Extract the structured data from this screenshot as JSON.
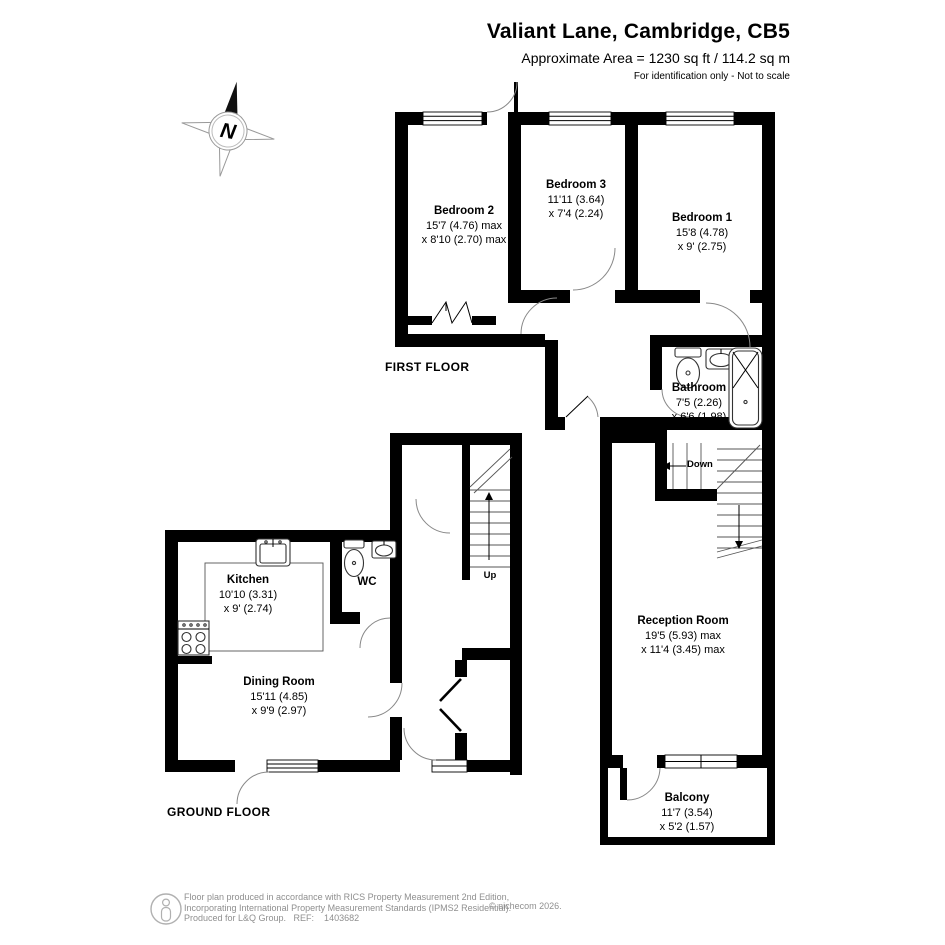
{
  "header": {
    "title": "Valiant Lane, Cambridge, CB5",
    "subtitle": "Approximate Area = 1230 sq ft / 114.2 sq m",
    "note": "For identification only - Not to scale"
  },
  "compass": {
    "label": "N"
  },
  "floors": {
    "first": "FIRST FLOOR",
    "ground": "GROUND FLOOR"
  },
  "rooms": {
    "bedroom2": {
      "name": "Bedroom 2",
      "dim1": "15'7 (4.76) max",
      "dim2": "x 8'10 (2.70) max"
    },
    "bedroom3": {
      "name": "Bedroom 3",
      "dim1": "11'11 (3.64)",
      "dim2": "x 7'4 (2.24)"
    },
    "bedroom1": {
      "name": "Bedroom 1",
      "dim1": "15'8 (4.78)",
      "dim2": "x 9' (2.75)"
    },
    "bathroom": {
      "name": "Bathroom",
      "dim1": "7'5 (2.26)",
      "dim2": "x 6'6 (1.98)"
    },
    "kitchen": {
      "name": "Kitchen",
      "dim1": "10'10 (3.31)",
      "dim2": "x 9' (2.74)"
    },
    "wc": {
      "name": "WC"
    },
    "dining_room": {
      "name": "Dining Room",
      "dim1": "15'11 (4.85)",
      "dim2": "x 9'9 (2.97)"
    },
    "reception_room": {
      "name": "Reception Room",
      "dim1": "19'5 (5.93) max",
      "dim2": "x 11'4 (3.45) max"
    },
    "balcony": {
      "name": "Balcony",
      "dim1": "11'7 (3.54)",
      "dim2": "x 5'2 (1.57)"
    }
  },
  "stairs": {
    "up": "Up",
    "down": "Down"
  },
  "footer": {
    "line1": "Floor plan produced in accordance with RICS Property Measurement 2nd Edition,",
    "line2": "Incorporating International Property Measurement Standards (IPMS2 Residential).",
    "line3": "Produced for L&Q Group.   REF:    1403682",
    "copyright": "© nichecom 2026."
  },
  "colors": {
    "wall": "#000000",
    "background": "#ffffff",
    "detail": "#8f8f8f"
  }
}
